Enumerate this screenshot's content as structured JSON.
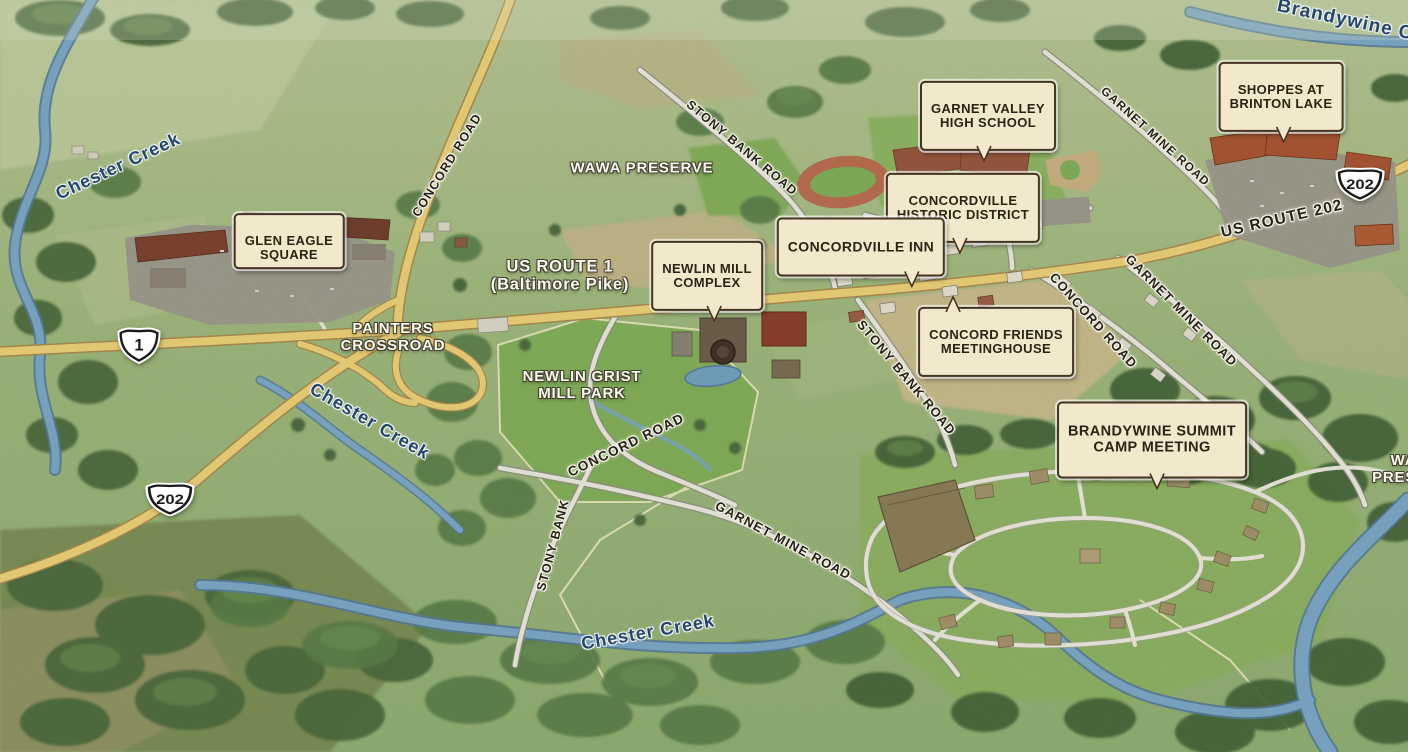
{
  "title": "Concordville area illustrated aerial map",
  "map": {
    "callouts": {
      "glen_eagle_square": "GLEN EAGLE\nSQUARE",
      "garnet_valley_high_school": "GARNET VALLEY\nHIGH SCHOOL",
      "shoppes_at_brinton_lake": "SHOPPES AT\nBRINTON LAKE",
      "concordville_historic_district": "CONCORDVILLE\nHISTORIC DISTRICT",
      "concordville_inn": "CONCORDVILLE INN",
      "newlin_mill_complex": "NEWLIN MILL\nCOMPLEX",
      "concord_friends_meetinghouse": "CONCORD FRIENDS\nMEETINGHOUSE",
      "brandywine_summit_camp_meeting": "BRANDYWINE SUMMIT\nCAMP MEETING"
    },
    "area_labels": {
      "wawa_preserve": "WAWA PRESERVE",
      "us_route_1": "US ROUTE 1\n(Baltimore Pike)",
      "painters_crossroad": "PAINTERS\nCROSSROAD",
      "newlin_grist_mill_park": "NEWLIN GRIST\nMILL PARK",
      "wawa_preserve_edge": "WAWA\nPRESERVE"
    },
    "road_labels": {
      "concord_road_north": "CONCORD ROAD",
      "stony_bank_road_north": "STONY BANK ROAD",
      "garnet_mine_road_north": "GARNET MINE ROAD",
      "us_route_202": "US ROUTE 202",
      "concord_road_east": "CONCORD ROAD",
      "garnet_mine_road_east": "GARNET MINE ROAD",
      "stony_bank_road_mid": "STONY BANK ROAD",
      "concord_road_mid": "CONCORD ROAD",
      "stony_bank_south": "STONY BANK",
      "garnet_mine_road_south": "GARNET MINE ROAD"
    },
    "creek_labels": {
      "brandywine_creek": "Brandywine Cre",
      "chester_creek_upper": "Chester Creek",
      "chester_creek_middle": "Chester Creek",
      "chester_creek_lower": "Chester Creek"
    },
    "shields": {
      "us_1": "1",
      "us_202_east": "202",
      "us_202_west": "202"
    },
    "colors": {
      "highway": "#eed077",
      "minor_road": "#ebe9df",
      "water": "#79a6c8",
      "callout_bg": "#f2e9cd",
      "callout_border": "#453520",
      "creek_text": "#24476e"
    }
  }
}
